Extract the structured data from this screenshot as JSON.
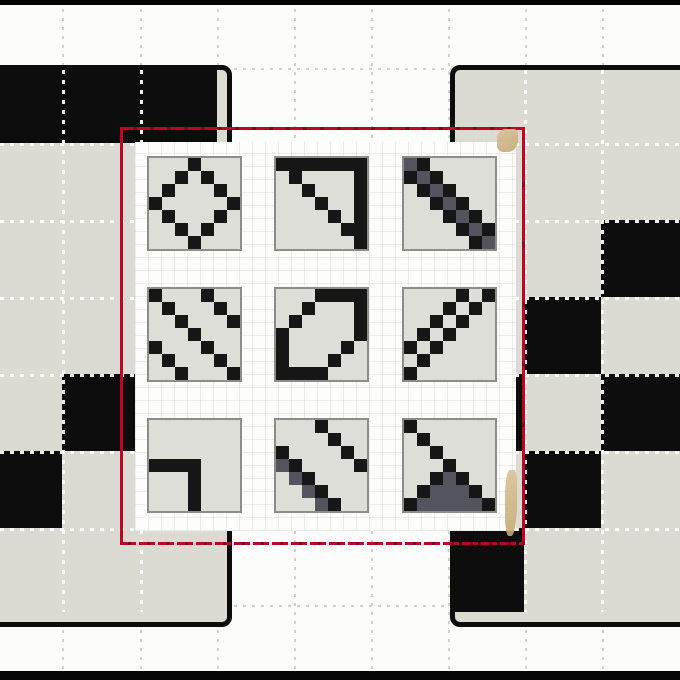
{
  "scene": {
    "description": "Pattern-matrix puzzle: red selection marquee popup showing a 3x3 palette of 7x7 pixel-pattern tiles, overlaid on two large black-and-grey pattern boards",
    "colors": {
      "page_background": "#fcfcfa",
      "board_fill": "#dbdbd4",
      "board_black": "#0d0d0d",
      "marquee_red": "#c00425",
      "marquee_dark_red": "#7c0a1c",
      "tile_background": "#dedeD8",
      "tile_border": "#8e8e88",
      "pattern_black": "#161616",
      "pattern_gray": "#54545e",
      "smudge_tan": "#d0b98a",
      "grid_dot_gray": "#d2d2cc",
      "grid_dot_white": "#ffffff"
    }
  },
  "pattern_legend": {
    "0": "empty",
    "1": "black",
    "2": "dark-gray"
  },
  "boards": {
    "left": {
      "cell_rows": [
        "111",
        "000",
        "000",
        "000",
        "010",
        "100",
        "000"
      ]
    },
    "right": {
      "cell_rows": [
        "000",
        "000",
        "001",
        "010",
        "101",
        "010",
        "100"
      ]
    }
  },
  "palette": {
    "rows": 3,
    "cols": 3,
    "tiles": [
      {
        "name": "diamond-outline",
        "pattern": [
          "0001000",
          "0010100",
          "0100010",
          "1000001",
          "0100010",
          "0010100",
          "0001000"
        ]
      },
      {
        "name": "right-triangle-outline",
        "pattern": [
          "1111111",
          "0100001",
          "0010001",
          "0001001",
          "0000101",
          "0000011",
          "0000001"
        ]
      },
      {
        "name": "thick-diagonal-band",
        "pattern": [
          "2100000",
          "1210000",
          "0121000",
          "0012100",
          "0001210",
          "0000121",
          "0000012"
        ]
      },
      {
        "name": "double-diagonal-lines",
        "pattern": [
          "1000100",
          "0100010",
          "0010001",
          "0001000",
          "1000100",
          "0100010",
          "0010001"
        ]
      },
      {
        "name": "leaf-outline",
        "pattern": [
          "0001111",
          "0010001",
          "0100001",
          "1000001",
          "1000010",
          "1000100",
          "1111000"
        ]
      },
      {
        "name": "checkered-anti-diagonal",
        "pattern": [
          "0000101",
          "0001010",
          "0010100",
          "0101000",
          "1010000",
          "0100000",
          "1000000"
        ]
      },
      {
        "name": "corner-elbow",
        "pattern": [
          "0000000",
          "0000000",
          "0000000",
          "1111000",
          "0001000",
          "0001000",
          "0001000"
        ]
      },
      {
        "name": "split-diagonals",
        "pattern": [
          "0001000",
          "0000100",
          "1000010",
          "2100001",
          "0210000",
          "0021000",
          "0002100"
        ]
      },
      {
        "name": "diagonal-into-triangle",
        "pattern": [
          "1000000",
          "0100000",
          "0010000",
          "0001000",
          "0012100",
          "0122210",
          "1222221"
        ]
      }
    ]
  }
}
